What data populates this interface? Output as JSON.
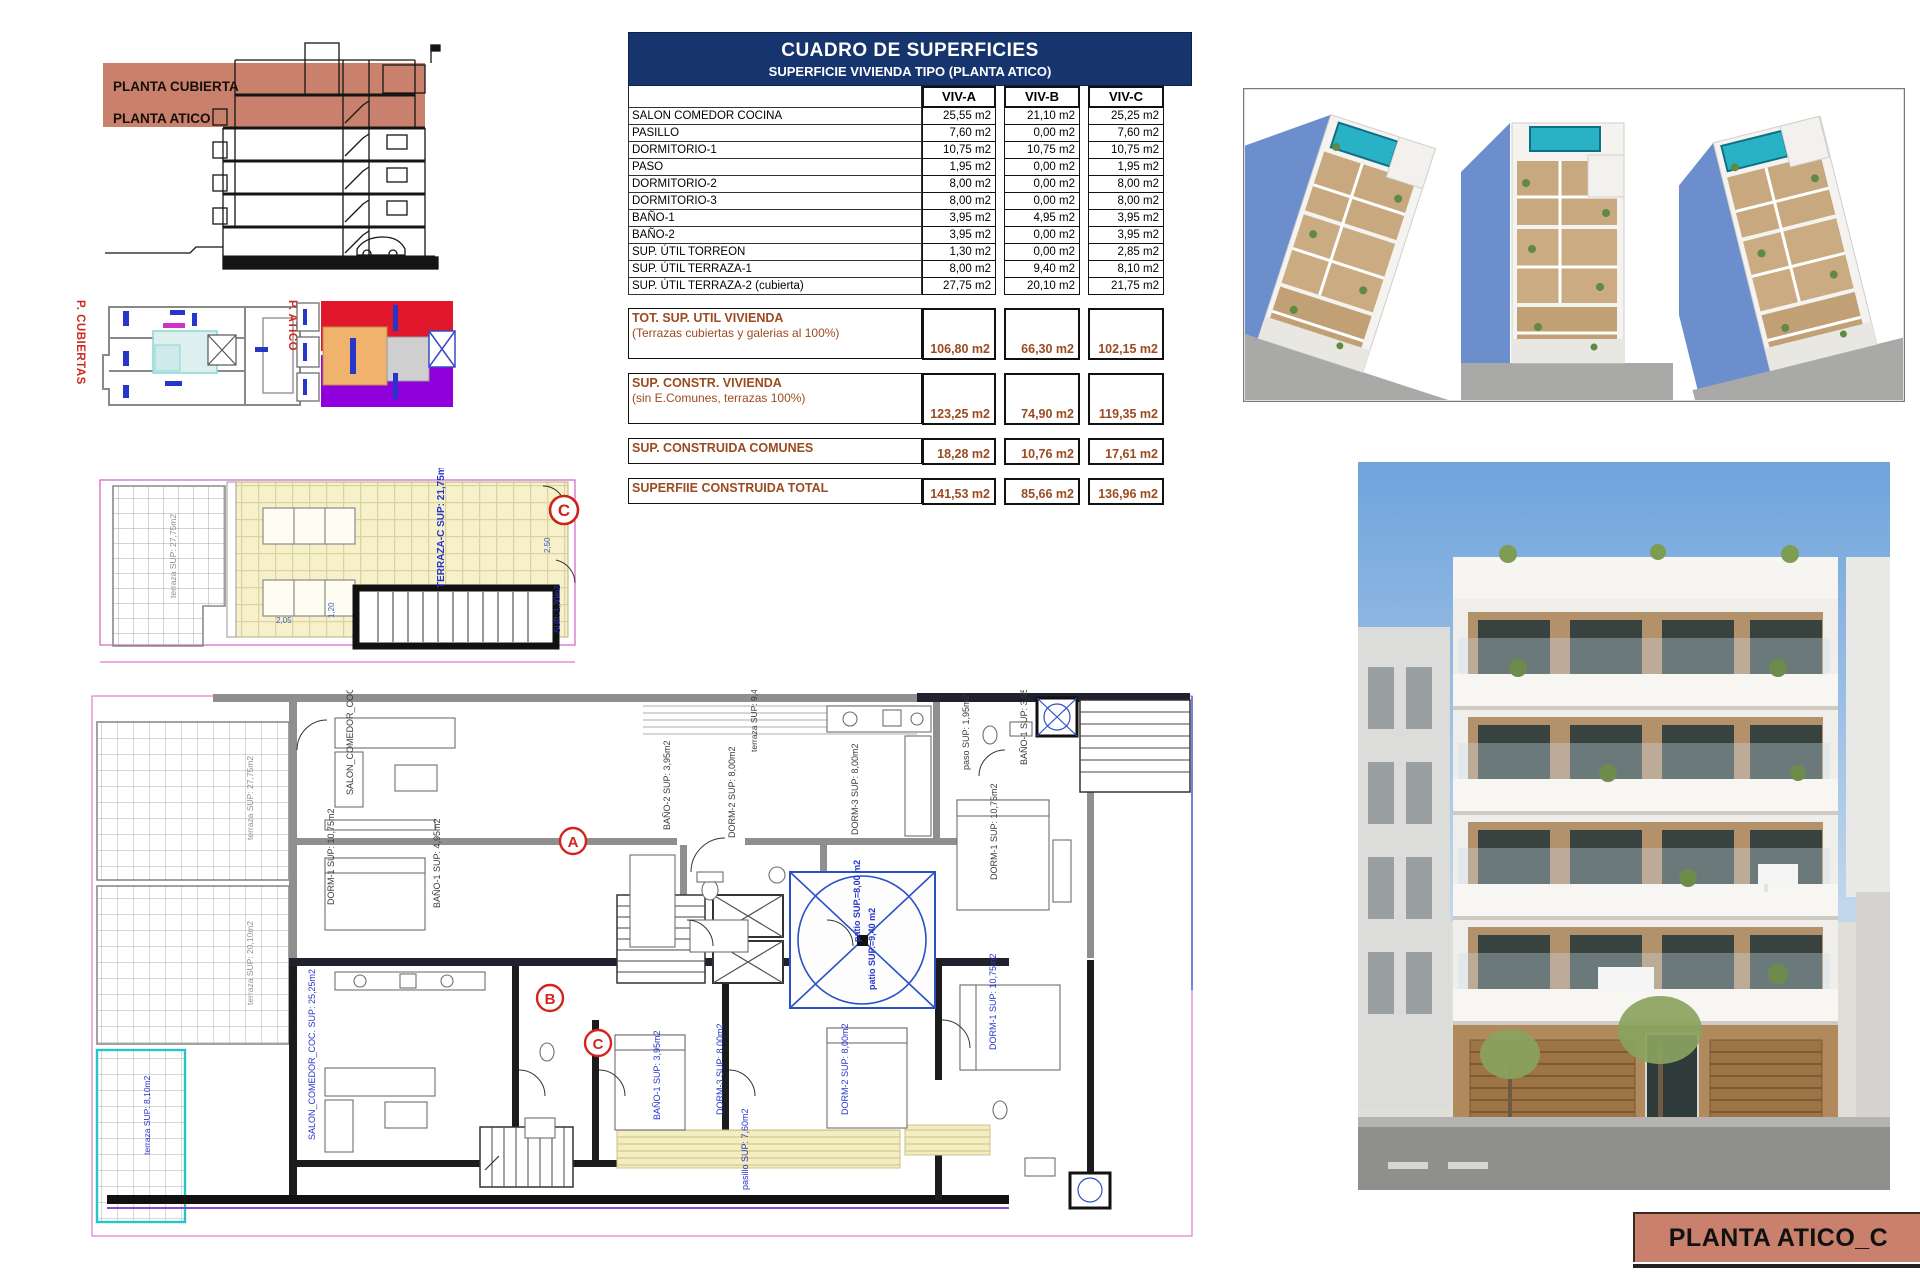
{
  "sheet": {
    "title_bar": "PLANTA ATICO_C"
  },
  "colors": {
    "salmon_band": "#c9806c",
    "table_header_navy": "#16356e",
    "summary_brown": "#9c4a1f",
    "marker_red": "#d3231c",
    "plan_label_blue": "#2636c8",
    "boundary_pink": "#e07ad0",
    "terrace_yellow": "#f6f1cb",
    "terrace_cyan": "#26c6c6",
    "pool_teal": "#29b2c6"
  },
  "section_drawing": {
    "label_top": "PLANTA CUBIERTA",
    "label_bottom": "PLANTA ATICO"
  },
  "key_plans": {
    "cubiertas_label": "P. CUBIERTAS",
    "atico_label": "P. ATICO"
  },
  "surface_table": {
    "title": "CUADRO DE SUPERFICIES",
    "subtitle": "SUPERFICIE VIVIENDA TIPO  (PLANTA ATICO)",
    "columns": [
      "VIV-A",
      "VIV-B",
      "VIV-C"
    ],
    "rows": [
      {
        "label": "SALON COMEDOR COCINA",
        "a": "25,55 m2",
        "b": "21,10 m2",
        "c": "25,25 m2"
      },
      {
        "label": "PASILLO",
        "a": "7,60 m2",
        "b": "0,00 m2",
        "c": "7,60 m2"
      },
      {
        "label": "DORMITORIO-1",
        "a": "10,75 m2",
        "b": "10,75 m2",
        "c": "10,75 m2"
      },
      {
        "label": "PASO",
        "a": "1,95 m2",
        "b": "0,00 m2",
        "c": "1,95 m2"
      },
      {
        "label": "DORMITORIO-2",
        "a": "8,00 m2",
        "b": "0,00 m2",
        "c": "8,00 m2"
      },
      {
        "label": "DORMITORIO-3",
        "a": "8,00 m2",
        "b": "0,00 m2",
        "c": "8,00 m2"
      },
      {
        "label": "BAÑO-1",
        "a": "3,95 m2",
        "b": "4,95 m2",
        "c": "3,95 m2"
      },
      {
        "label": "BAÑO-2",
        "a": "3,95 m2",
        "b": "0,00 m2",
        "c": "3,95 m2"
      },
      {
        "label": "SUP. ÚTIL TORREON",
        "a": "1,30 m2",
        "b": "0,00 m2",
        "c": "2,85 m2"
      },
      {
        "label": "SUP. ÚTIL TERRAZA-1",
        "a": "8,00 m2",
        "b": "9,40 m2",
        "c": "8,10 m2"
      },
      {
        "label": "SUP. ÚTIL TERRAZA-2 (cubierta)",
        "a": "27,75 m2",
        "b": "20,10 m2",
        "c": "21,75 m2"
      }
    ],
    "summary": [
      {
        "label": "TOT. SUP. UTIL VIVIENDA",
        "note": "(Terrazas cubiertas y galerias al 100%)",
        "a": "106,80 m2",
        "b": "66,30 m2",
        "c": "102,15 m2"
      },
      {
        "label": "SUP. CONSTR. VIVIENDA",
        "note": "(sin E.Comunes, terrazas 100%)",
        "a": "123,25 m2",
        "b": "74,90 m2",
        "c": "119,35 m2"
      },
      {
        "label": "SUP. CONSTRUIDA COMUNES",
        "note": "",
        "a": "18,28 m2",
        "b": "10,76 m2",
        "c": "17,61 m2"
      },
      {
        "label": "SUPERFIIE CONSTRUIDA TOTAL",
        "note": "",
        "a": "141,53 m2",
        "b": "85,66 m2",
        "c": "136,96 m2"
      }
    ]
  },
  "terrace_plan": {
    "marker": "C",
    "labels": [
      {
        "text": "TERRAZA-C  SUP: 21,75m2"
      },
      {
        "text": "terraza  SUP: 27,75m2"
      },
      {
        "text": "SUP: 1,30m2"
      }
    ],
    "dims": [
      "2,50",
      "2,05",
      "1,20"
    ]
  },
  "floor_plan": {
    "markers": [
      {
        "letter": "A"
      },
      {
        "letter": "B"
      },
      {
        "letter": "C"
      }
    ],
    "labels": [
      {
        "text": "SALON_COMEDOR_COC.  SUP: 25,55m2"
      },
      {
        "text": "DORM-1  SUP: 10,75m2"
      },
      {
        "text": "BAÑO-1  SUP: 4,95m2"
      },
      {
        "text": "BAÑO-2  SUP: 3,95m2"
      },
      {
        "text": "DORM-2  SUP: 8,00m2"
      },
      {
        "text": "DORM-3  SUP: 8,00m2"
      },
      {
        "text": "paso  SUP: 1,95m2"
      },
      {
        "text": "BAÑO-1  SUP: 3,95m2"
      },
      {
        "text": "DORM-1  SUP: 10,75m2"
      },
      {
        "text": "patio  SUP.=8,00 m2"
      },
      {
        "text": "patio  SUP.=9,40 m2"
      },
      {
        "text": "SALON_COMEDOR_COC.  SUP: 25,25m2"
      },
      {
        "text": "BAÑO-1  SUP: 3,95m2"
      },
      {
        "text": "DORM-3  SUP: 8,00m2"
      },
      {
        "text": "DORM-2  SUP: 8,00m2"
      },
      {
        "text": "pasillo  SUP: 7,60m2"
      },
      {
        "text": "DORM-1  SUP: 10,75m2"
      },
      {
        "text": "terraza  SUP: 27,75m2"
      },
      {
        "text": "terraza  SUP: 20,10m2"
      },
      {
        "text": "terraza  SUP: 8,10m2"
      },
      {
        "text": "terraza  SUP: 9,40m2"
      }
    ]
  }
}
